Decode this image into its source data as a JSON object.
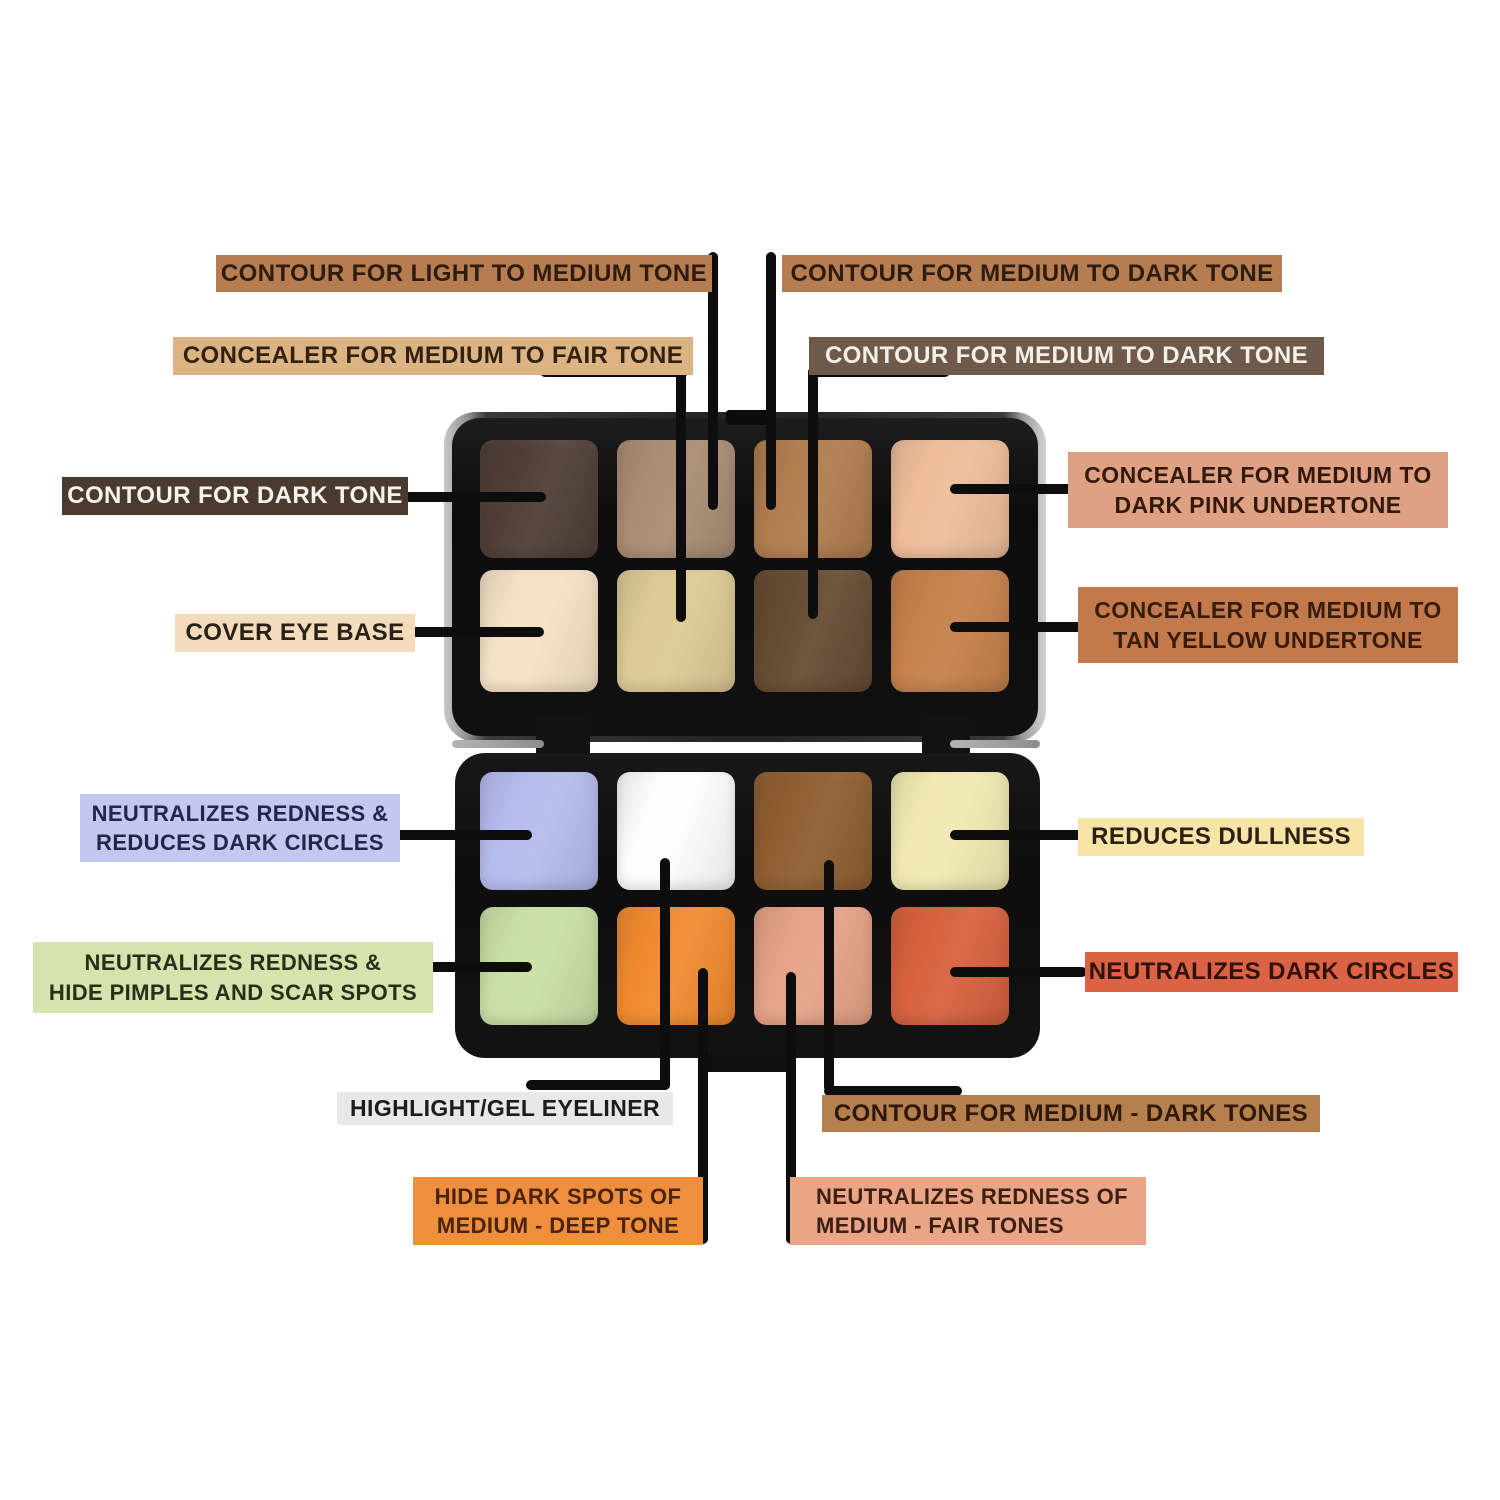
{
  "figure": {
    "type": "product-infographic",
    "subject": "16-shade cream contour and concealer palette shown open with callout annotations",
    "background": "#ffffff",
    "connector_color": "#0d0d0d"
  },
  "palette": {
    "case_color": "#111111",
    "lid_shades": {
      "row1": [
        {
          "name": "dark contour brown",
          "color": "#4f3e36"
        },
        {
          "name": "light-medium contour tan",
          "color": "#a98c74"
        },
        {
          "name": "medium-dark contour caramel",
          "color": "#b07c4e"
        },
        {
          "name": "pink undertone concealer peach",
          "color": "#eebd99"
        }
      ],
      "row2": [
        {
          "name": "cover eye base cream",
          "color": "#f5e2c6"
        },
        {
          "name": "medium-fair concealer beige",
          "color": "#ddca94"
        },
        {
          "name": "medium-dark contour chocolate",
          "color": "#664b33"
        },
        {
          "name": "tan yellow undertone concealer",
          "color": "#c6804b"
        }
      ]
    },
    "base_shades": {
      "row1": [
        {
          "name": "lavender corrector",
          "color": "#b5bcee"
        },
        {
          "name": "highlight white",
          "color": "#fdfdfd"
        },
        {
          "name": "medium-dark contour brown",
          "color": "#8f5e31"
        },
        {
          "name": "yellow dullness corrector",
          "color": "#f2e9b2"
        }
      ],
      "row2": [
        {
          "name": "green corrector",
          "color": "#cadfa5"
        },
        {
          "name": "orange corrector",
          "color": "#f18a2f"
        },
        {
          "name": "salmon corrector",
          "color": "#e5a287"
        },
        {
          "name": "red-terracotta corrector",
          "color": "#d7613e"
        }
      ]
    }
  },
  "labels": {
    "contour_light_medium": {
      "text": "CONTOUR FOR LIGHT TO MEDIUM TONE",
      "bg": "#b67e50",
      "fg": "#2e1c10"
    },
    "contour_medium_dark_top": {
      "text": "CONTOUR FOR MEDIUM TO DARK TONE",
      "bg": "#b67e50",
      "fg": "#2e1c10"
    },
    "concealer_medium_fair": {
      "text": "CONCEALER FOR MEDIUM TO FAIR TONE",
      "bg": "#dcb383",
      "fg": "#32210f"
    },
    "contour_medium_dark_2": {
      "text": "CONTOUR FOR MEDIUM TO DARK TONE",
      "bg": "#6f594a",
      "fg": "#f4efe7"
    },
    "contour_dark": {
      "text": "CONTOUR FOR DARK TONE",
      "bg": "#4b3a2f",
      "fg": "#f7f3ec"
    },
    "concealer_pink_undertone": {
      "text": "CONCEALER FOR MEDIUM TO\nDARK PINK UNDERTONE",
      "bg": "#dfa184",
      "fg": "#33180c"
    },
    "cover_eye_base": {
      "text": "COVER EYE BASE",
      "bg": "#f3dcbb",
      "fg": "#2b2018"
    },
    "concealer_tan_yellow": {
      "text": "CONCEALER FOR MEDIUM TO\nTAN YELLOW UNDERTONE",
      "bg": "#c2794b",
      "fg": "#361c0b"
    },
    "neutralizes_redness_circles": {
      "text": "NEUTRALIZES REDNESS &\nREDUCES DARK CIRCLES",
      "bg": "#c4c7f0",
      "fg": "#23254a"
    },
    "reduces_dullness": {
      "text": "REDUCES DULLNESS",
      "bg": "#f7e4a7",
      "fg": "#2b2115"
    },
    "neutralizes_redness_pimples": {
      "text": "NEUTRALIZES REDNESS &\nHIDE PIMPLES AND SCAR SPOTS",
      "bg": "#d5e4ad",
      "fg": "#25301a"
    },
    "neutralizes_dark_circles": {
      "text": "NEUTRALIZES DARK CIRCLES",
      "bg": "#db6244",
      "fg": "#2f130a"
    },
    "highlight_gel_eyeliner": {
      "text": "HIGHLIGHT/GEL EYELINER",
      "bg": "#e8e8e8",
      "fg": "#1c1c1c"
    },
    "contour_medium_dark_tones": {
      "text": "CONTOUR FOR MEDIUM - DARK TONES",
      "bg": "#b5804e",
      "fg": "#30190b"
    },
    "hide_dark_spots": {
      "text": "HIDE DARK SPOTS OF\nMEDIUM - DEEP TONE",
      "bg": "#ef8f3d",
      "fg": "#4b240f"
    },
    "neutralizes_redness_fair": {
      "text": "NEUTRALIZES REDNESS OF\nMEDIUM - FAIR TONES",
      "bg": "#eaa586",
      "fg": "#3d2013"
    }
  }
}
